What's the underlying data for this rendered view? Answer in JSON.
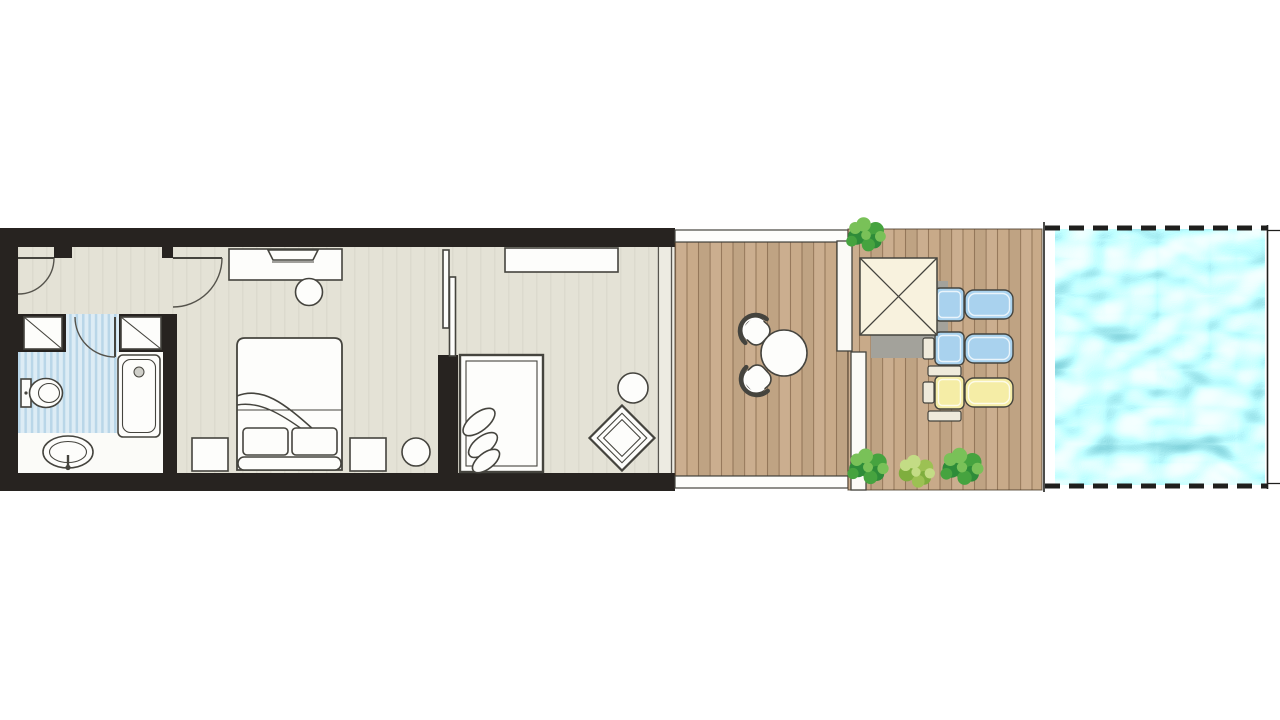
{
  "canvas": {
    "width": 1280,
    "height": 720,
    "background": "#ffffff"
  },
  "colors": {
    "bg": "#ffffff",
    "wall": "#272320",
    "outline": "#45443e",
    "door-arc": "#55534c",
    "floor": "#e4e2d6",
    "glass": "#edebe2",
    "white": "#fbfbf8",
    "fixture": "#fdfdfb",
    "tile-a": "#ddecf5",
    "tile-b": "#b9d6e8",
    "deck": "#c8aa89",
    "deck-line": "#7d5f43",
    "deck-edge": "#4a3a28",
    "ledge": "#fdfdfb",
    "screen": "#fbfaf6",
    "umbrella": "#f8f2de",
    "umbrella-shadow": "#a3a29b",
    "lounger-blue": "#a9d2ee",
    "lounger-yellow": "#f5eda6",
    "lounger-pale": "#efeadb",
    "plant-1": "#2e8c39",
    "plant-2": "#46a33f",
    "plant-3": "#79c158",
    "plant-l1": "#7fae3e",
    "plant-l2": "#9cc153",
    "plant-l3": "#c3dc85",
    "pool": "#41b2c1",
    "pool-highlight": "#e9fbf0",
    "dash": "#1f1f1d"
  },
  "floorplan": {
    "type": "suite-with-private-pool-floor-plan",
    "areas": [
      {
        "name": "entry-vestibule"
      },
      {
        "name": "bathroom"
      },
      {
        "name": "bedroom"
      },
      {
        "name": "living-area"
      },
      {
        "name": "wooden-deck"
      },
      {
        "name": "sun-deck"
      },
      {
        "name": "private-pool"
      }
    ],
    "furniture": [
      "entry-door",
      "closet-left",
      "closet-right",
      "bathroom-door",
      "toilet",
      "bathtub",
      "washbasin",
      "desk",
      "laptop",
      "desk-chair",
      "double-bed",
      "bed-pillows",
      "nightstand-left",
      "nightstand-right",
      "ottoman",
      "sliding-door",
      "console-shelf",
      "daybed",
      "daybed-cushions",
      "side-table",
      "lounge-chair",
      "glass-wall",
      "outdoor-table",
      "outdoor-chair-upper",
      "outdoor-chair-lower",
      "pergola-parasol",
      "parasol-shadow",
      "sun-lounger-blue-1",
      "sun-lounger-blue-2",
      "sun-lounger-yellow",
      "deck-side-tables",
      "privacy-screens",
      "shrubs",
      "pool-water"
    ]
  }
}
